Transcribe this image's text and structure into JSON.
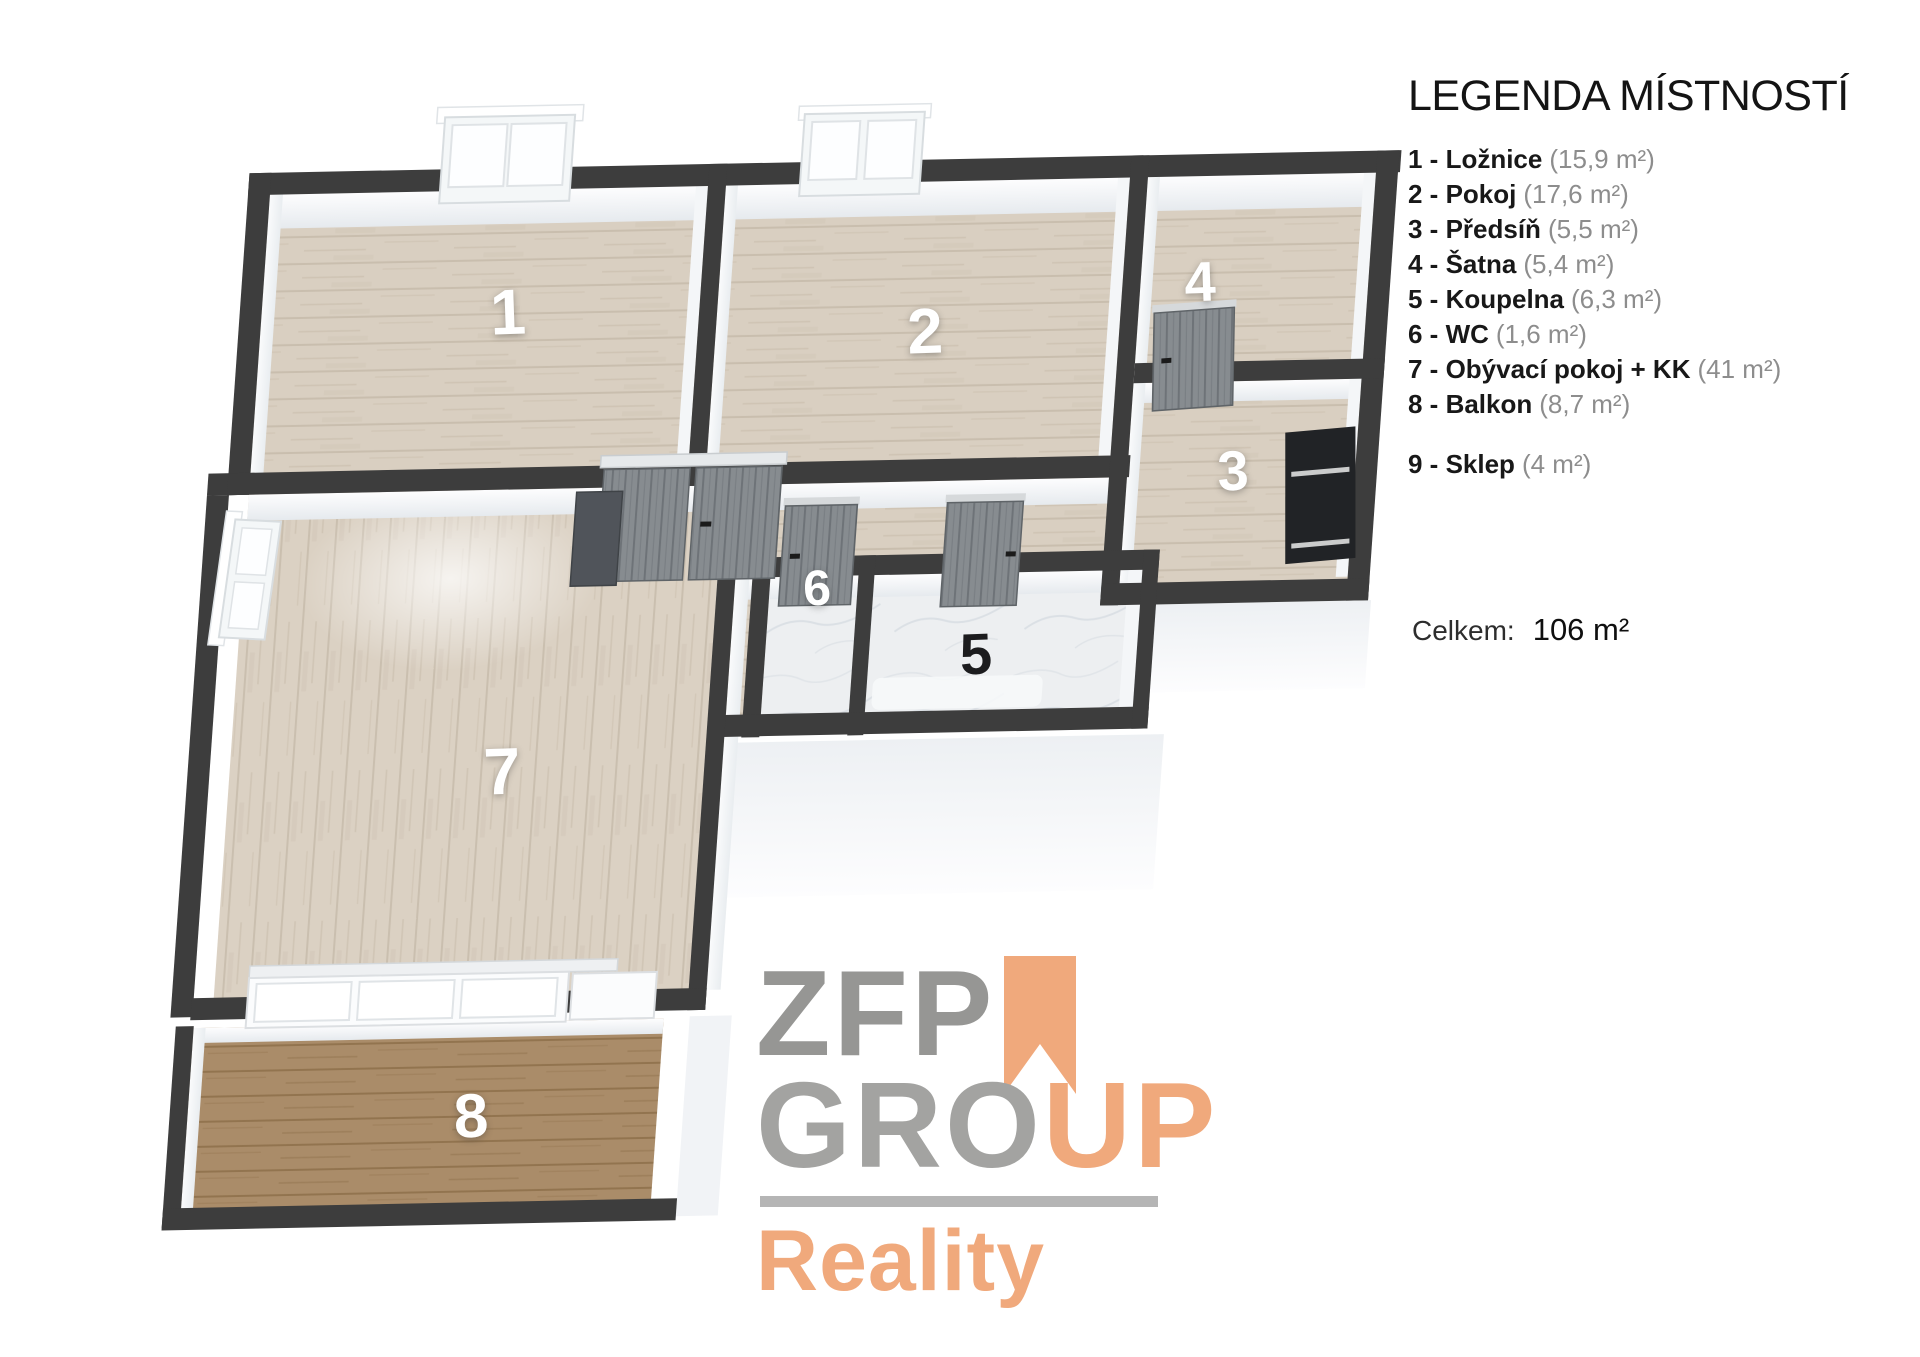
{
  "legend": {
    "title": "LEGENDA MÍSTNOSTÍ",
    "items": [
      {
        "label": "1 - Ložnice",
        "area": "(15,9 m²)"
      },
      {
        "label": "2 - Pokoj",
        "area": "(17,6 m²)"
      },
      {
        "label": "3 - Předsíň",
        "area": "(5,5 m²)"
      },
      {
        "label": "4 - Šatna",
        "area": "(5,4 m²)"
      },
      {
        "label": "5 - Koupelna",
        "area": "(6,3 m²)"
      },
      {
        "label": "6 - WC",
        "area": "(1,6 m²)"
      },
      {
        "label": "7 - Obývací pokoj + KK",
        "area": "(41 m²)"
      },
      {
        "label": "8 - Balkon",
        "area": "(8,7 m²)"
      },
      {
        "label": "9 - Sklep",
        "area": "(4 m²)"
      }
    ],
    "total_label": "Celkem:",
    "total_value": "106 m²"
  },
  "plan": {
    "rooms": [
      {
        "number": "1"
      },
      {
        "number": "2"
      },
      {
        "number": "3"
      },
      {
        "number": "4"
      },
      {
        "number": "5"
      },
      {
        "number": "6"
      },
      {
        "number": "7"
      },
      {
        "number": "8"
      }
    ],
    "colors": {
      "wall": "#3d3d3d",
      "wood_light": "#d9cfc1",
      "wood_balcony": "#aa8c69",
      "marble": "#edeff1",
      "door_gray": "#878c90"
    }
  },
  "logo": {
    "zfp": "ZFP",
    "gro": "GRO",
    "up": "UP",
    "reality": "Reality",
    "colors": {
      "gray": "#9a9a98",
      "orange": "#f0a97c"
    }
  }
}
